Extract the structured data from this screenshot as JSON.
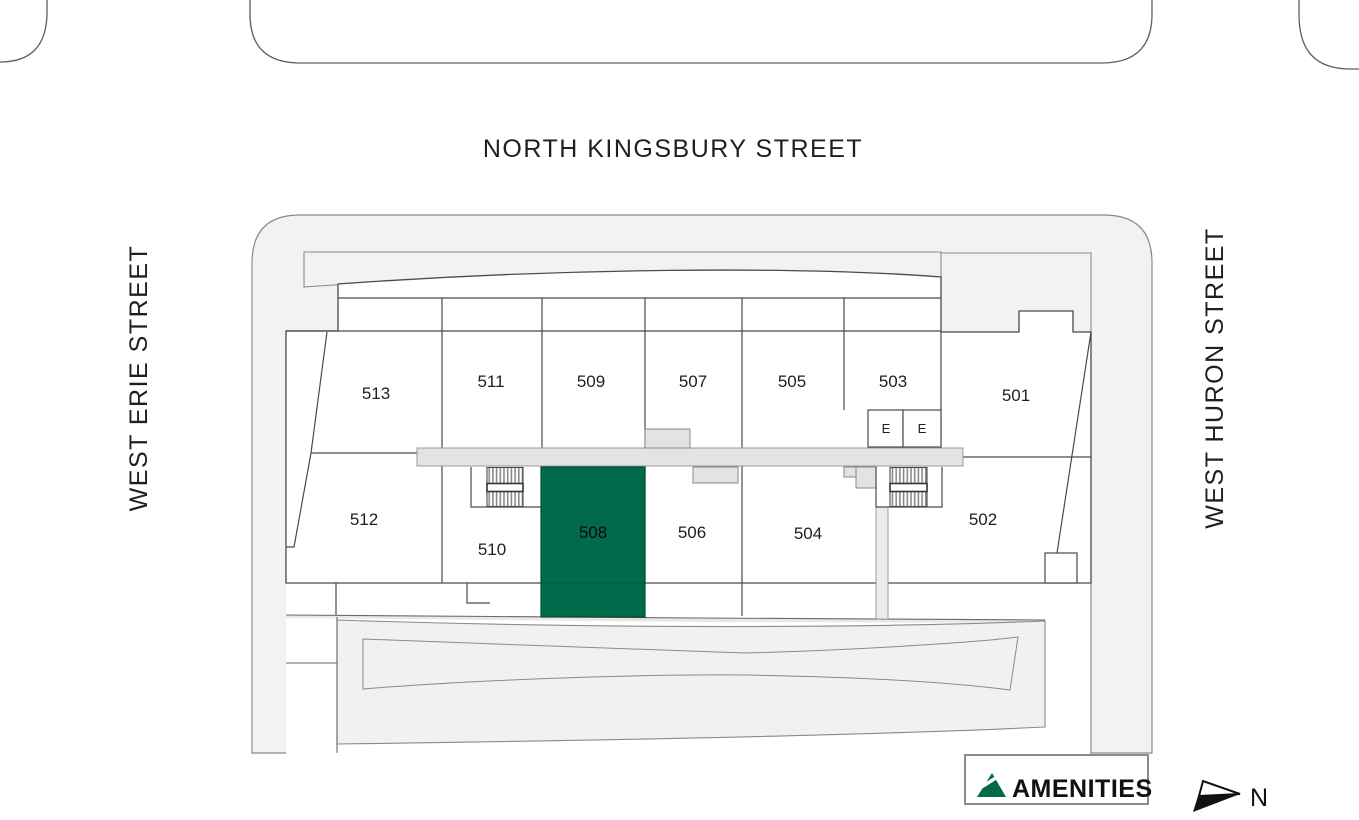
{
  "streets": {
    "top": "NORTH KINGSBURY STREET",
    "left": "WEST ERIE STREET",
    "right": "WEST HURON STREET"
  },
  "units": [
    {
      "label": "513",
      "highlighted": false
    },
    {
      "label": "511",
      "highlighted": false
    },
    {
      "label": "509",
      "highlighted": false
    },
    {
      "label": "507",
      "highlighted": false
    },
    {
      "label": "505",
      "highlighted": false
    },
    {
      "label": "503",
      "highlighted": false
    },
    {
      "label": "501",
      "highlighted": false
    },
    {
      "label": "512",
      "highlighted": false
    },
    {
      "label": "510",
      "highlighted": false
    },
    {
      "label": "508",
      "highlighted": true
    },
    {
      "label": "506",
      "highlighted": false
    },
    {
      "label": "504",
      "highlighted": false
    },
    {
      "label": "502",
      "highlighted": false
    }
  ],
  "elevators": {
    "label": "E"
  },
  "legend": {
    "amenities_label": "AMENITIES"
  },
  "compass": {
    "north_label": "N"
  },
  "highlighted_unit": "508",
  "colors": {
    "highlight_green": "#006a4b",
    "site_gray": "#f2f2f2",
    "corridor_gray": "#e3e3e3",
    "line_dark": "#4a4a4a"
  }
}
